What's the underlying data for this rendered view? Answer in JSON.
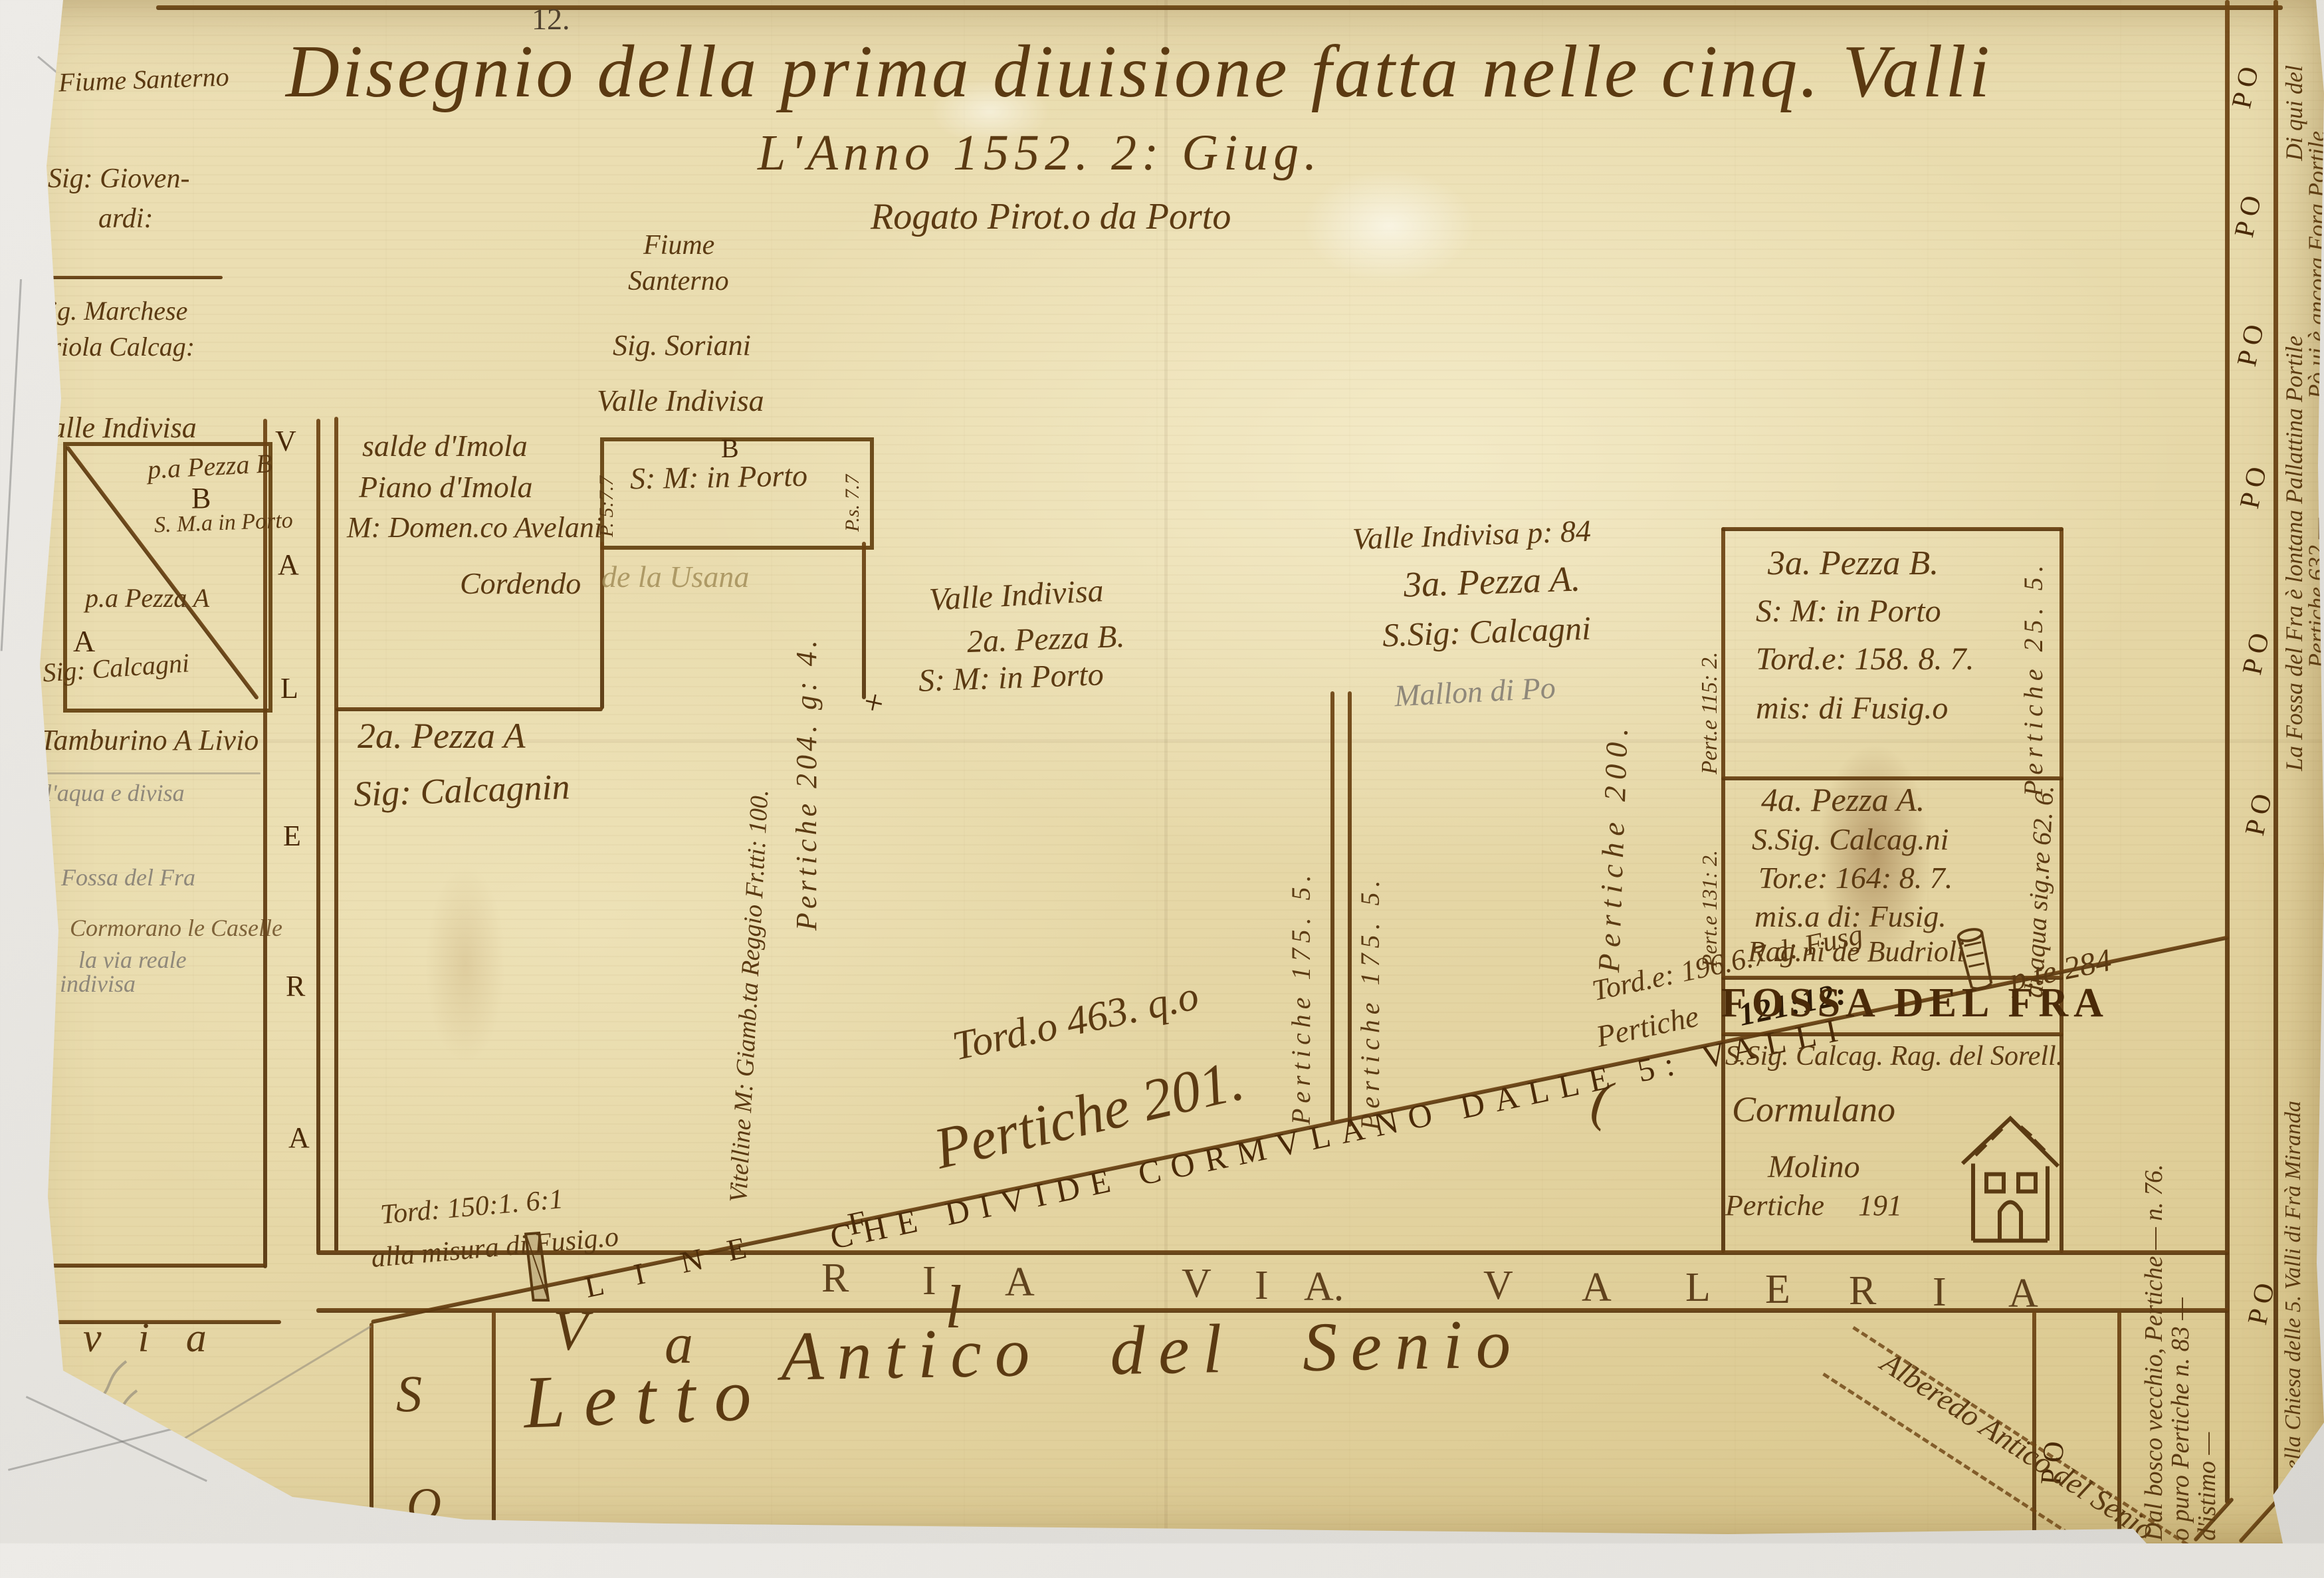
{
  "page_number": "12.",
  "title": {
    "line1": "Disegnio della prima diuisione fatta nelle cinq. Valli",
    "line2": "L'Anno 1552. 2: Giug.",
    "line3": "Rogato Pirot.o da Porto"
  },
  "left_margin": {
    "fiume": "Fiume Santerno",
    "giovenardi_1": "Sig: Gioven-",
    "giovenardi_2": "ardi:",
    "marchese_1": "Sig. Marchese",
    "marchese_2": "Eriola Calcag:",
    "valle_indivisa": "Valle Indivisa",
    "tamburino": "Tamburino A Livio",
    "acqua": "l'aqua e divisa",
    "fossa": "Fossa del Fra",
    "cormorano": "Cormorano le Caselle",
    "via_reale": "la via reale",
    "indivisa": "indivisa"
  },
  "prima_pezza": {
    "b_label": "p.a Pezza B",
    "b_letter": "B",
    "b_church": "S. M.a in Porto",
    "a_label": "p.a Pezza A",
    "a_letter": "A",
    "a_owner": "Sig: Calcagni"
  },
  "imola": {
    "l1": "salde d'Imola",
    "l2": "Piano d'Imola",
    "l3": "M: Domen.co Avelani"
  },
  "usana": {
    "dark": "Cordendo",
    "faded": "de la Usana"
  },
  "santerno": {
    "l1": "Fiume",
    "l2": "Santerno",
    "l3": "Sig. Soriani",
    "l4": "Valle Indivisa"
  },
  "box_b": {
    "letter": "B",
    "church": "S: M: in Porto",
    "left_measure": "P. 5:7.7",
    "right_measure": "P.s. 7.7",
    "cross": "+"
  },
  "pezza_2a": {
    "l1": "2a. Pezza A",
    "l2": "Sig: Calcagnin",
    "tord": "Tord: 150:1. 6:1",
    "misura": "alla misura di Fusig.o"
  },
  "pezza_2b": {
    "l1": "Valle Indivisa",
    "l2": "2a. Pezza B.",
    "l3": "S: M: in Porto"
  },
  "pezza_3a": {
    "l1": "Valle Indivisa p: 84",
    "l2": "3a. Pezza A.",
    "l3": "S.Sig: Calcagni",
    "faded": "Mallon di Po"
  },
  "verticals": {
    "pertiche_204": "Pertiche 204. g: 4.",
    "vitelline": "Vitelline M: Giamb.ta Reggio Fr.tti: 100.",
    "pertiche_175_left": "Pertiche 175. 5.",
    "pertiche_175_right": "Pertiche 175. 5.",
    "pertiche_200": "Pertiche 200."
  },
  "diagonal": {
    "linea": [
      "L",
      "I",
      "N",
      "E"
    ],
    "f": "F",
    "caps": "CHE DIVIDE CORMVLANO DALLE 5: VALLI",
    "pte": "p.te 284",
    "tord_463": "Tord.o 463. q.o",
    "pertiche_201": "Pertiche 201.",
    "tord_196": "Tord.e: 196.6.7 d: Fusg",
    "pertiche_121_label": "Pertiche",
    "pertiche_121_value": "121:12:",
    "hook": "("
  },
  "right_column": {
    "box1": {
      "l1": "3a. Pezza B.",
      "l2": "S: M: in Porto",
      "l3": "Tord.e: 158. 8. 7.",
      "l4": "mis: di Fusig.o",
      "left_measure": "Pert.e 115: 2.",
      "right_measure": "Pertiche 25. 5."
    },
    "box2": {
      "l1": "4a. Pezza A.",
      "l2": "S.Sig. Calcag.ni",
      "l3": "Tor.e: 164: 8. 7.",
      "l4": "mis.a di: Fusig.",
      "l5": "Rag.ni de Budrioli",
      "left_measure": "Pert.e 131: 2.",
      "right_measure": "di aqua sig.re 62. 6."
    },
    "fossa_strip": "FOSSA DEL FRA",
    "box3": {
      "l1": "S.Sig. Calcag. Rag. del Sorell.",
      "l2": "Cormulano",
      "l3": "Molino",
      "l4": "Pertiche 191"
    }
  },
  "roads": {
    "band1": [
      "R",
      "I",
      "A"
    ],
    "band2": [
      "V",
      "I",
      "A."
    ],
    "band3": [
      "V",
      "A"
    ],
    "band4": [
      "L",
      "E",
      "R",
      "I",
      "A"
    ],
    "via_cursive": "via",
    "big_v": "V",
    "big_a": "a",
    "big_l": "l",
    "letto": "Letto",
    "antico": "Antico del Senio",
    "left_road": [
      "V",
      "A",
      "L",
      "E",
      "R",
      "A"
    ],
    "po": "P O",
    "s_letter": "S",
    "o_letter": "O"
  },
  "right_margin": {
    "r1": "Di qui del",
    "r2": "Pò ui è ancora Fora Portile",
    "r3": "La Fossa del Fra è lontana Pallattina Portile",
    "r4": "Pertiche 632 —",
    "r5": "Dal bosco vecchio, Pertiche — n. 76.",
    "r6": "o puro Pertiche n. 83 —",
    "r7": "d'istimo —",
    "r8": "Fossa nella Chiesa delle 5. Valli di Frà Miranda"
  },
  "alberedo": "Alberedo Antico del Senio"
}
